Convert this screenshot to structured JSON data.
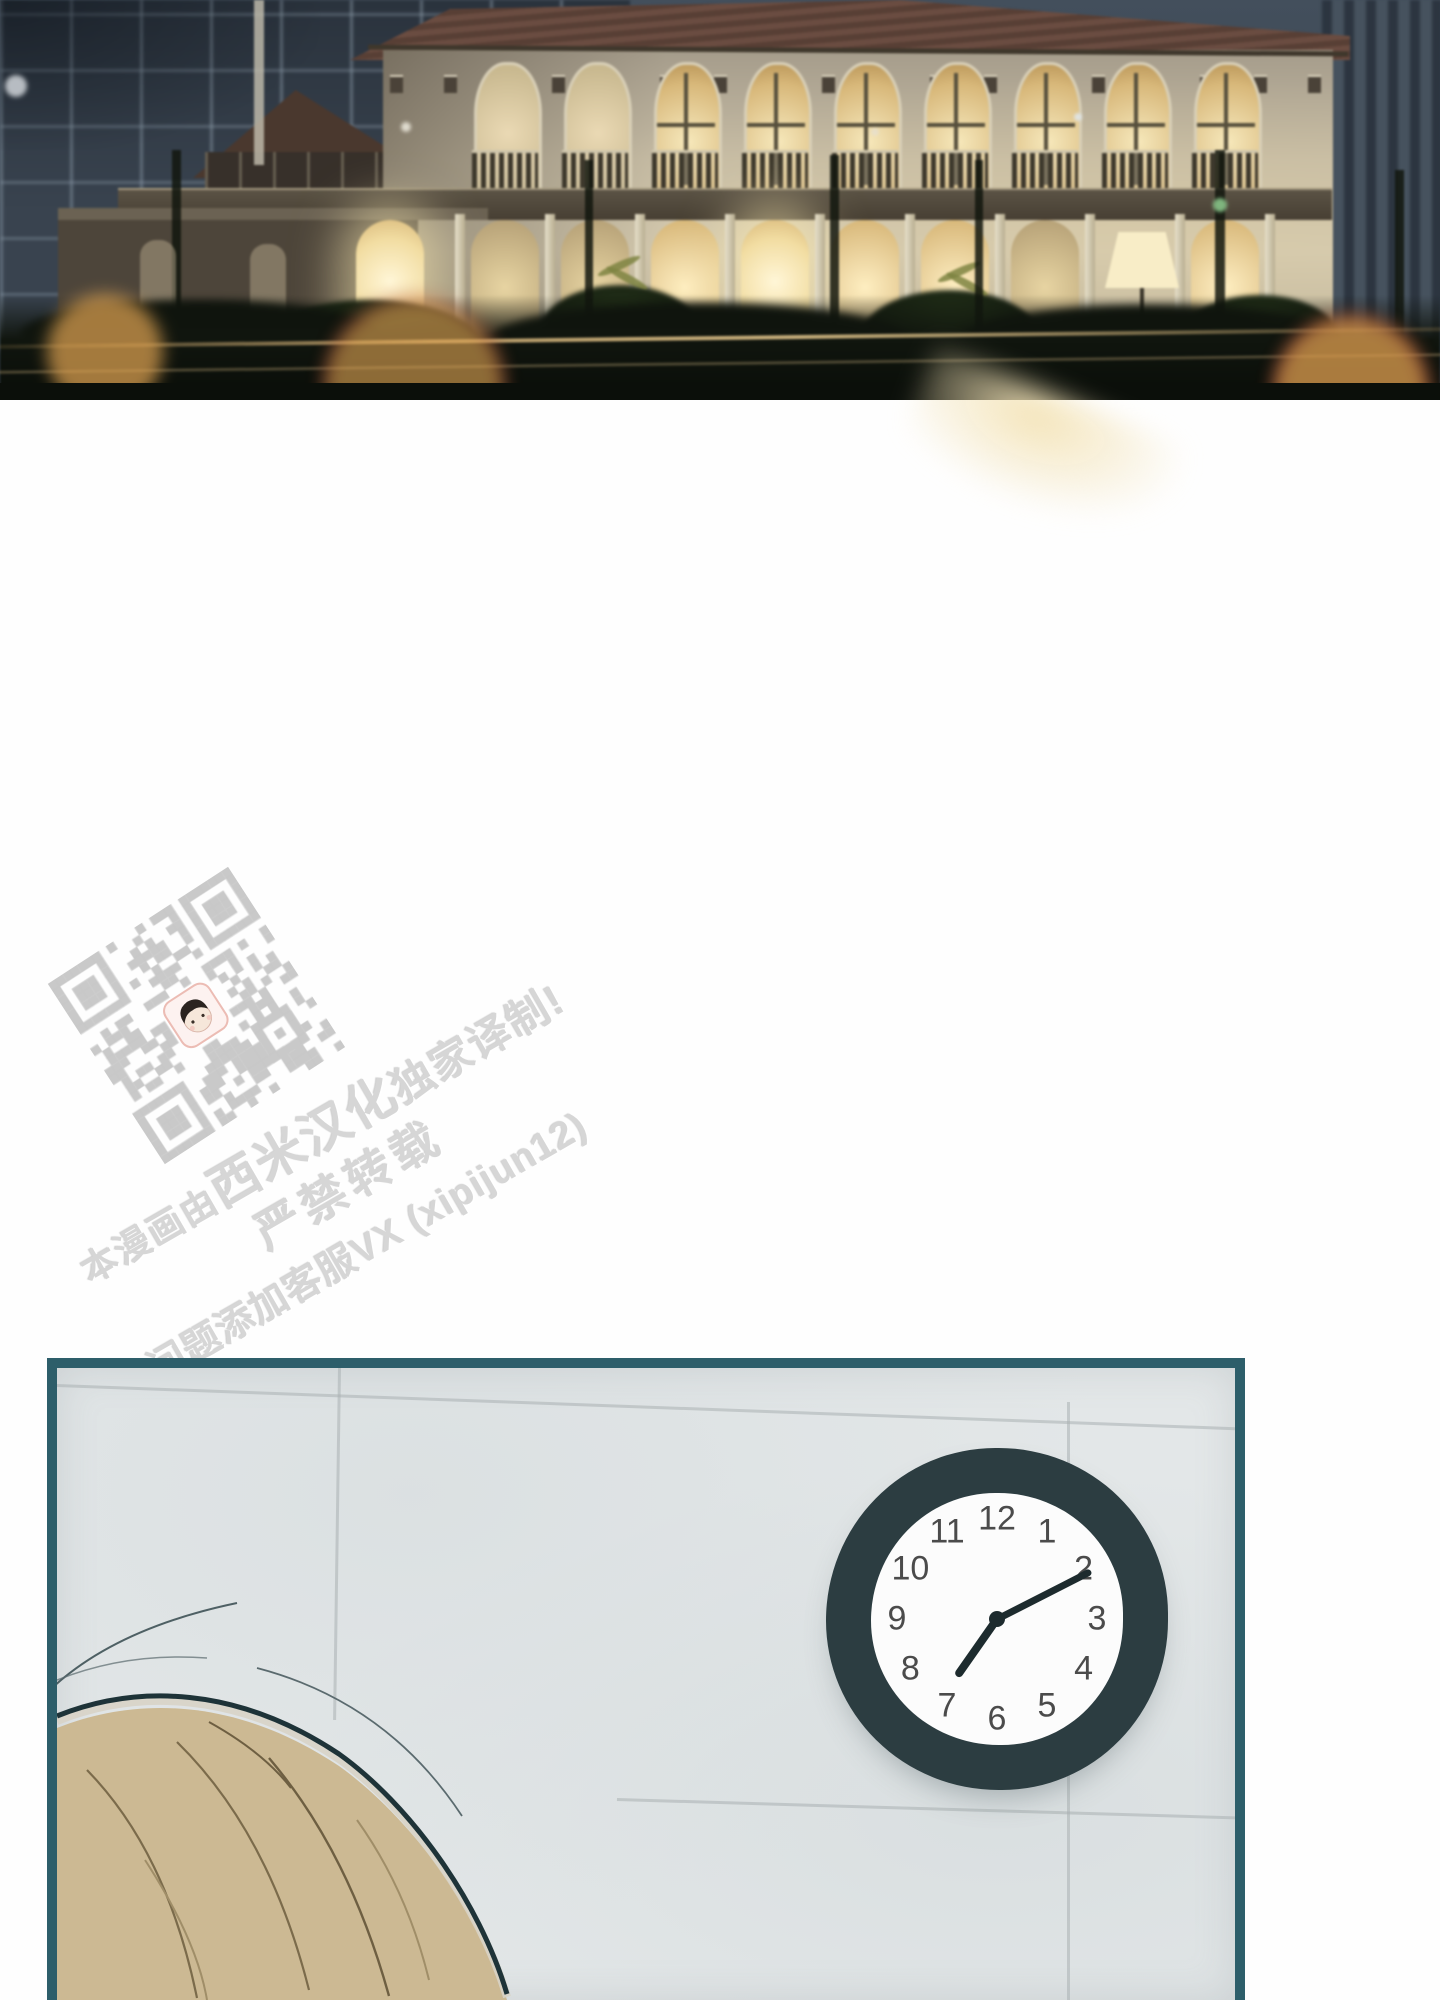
{
  "page": {
    "type": "webtoon-episode-page",
    "background": "#fefefe"
  },
  "panel1": {
    "description": "night scene of an illuminated two-story colonial building with arched glowing windows, dark blue background buildings, foreground fence and warm bokeh lights",
    "sky_color": "#3d4854",
    "wall_color": "#cfc5ad",
    "window_glow_color": "#f3e2ae",
    "bokeh_color": "#dfa24e"
  },
  "watermark": {
    "line1_prefix": "本漫画由",
    "line1_brand": "西米汉化",
    "line1_suffix": "独家译制!",
    "line2": "严禁转载",
    "line3": "有问题添加客服VX (xipijun12)",
    "text_color": "#d6d6d6",
    "qr": {
      "description": "translation-group qr-code watermark with chibi-face logo",
      "color": "#c9c9c9"
    }
  },
  "panel2": {
    "description": "interior wall of light gray tiles with wall clock; top of a blond head in lower-left corner",
    "border_color": "#2d5e6a",
    "wall_color": "#e3e7e8",
    "clock": {
      "numbers": [
        "12",
        "1",
        "2",
        "3",
        "4",
        "5",
        "6",
        "7",
        "8",
        "9",
        "10",
        "11"
      ],
      "time": "7:10",
      "rim_color": "#2c3d41",
      "face_color": "#fcfcfc",
      "hour_angle_deg": 215,
      "minute_angle_deg": 63
    },
    "character": {
      "hair_color": "#ccb993",
      "description": "top of blond head entering frame"
    }
  }
}
